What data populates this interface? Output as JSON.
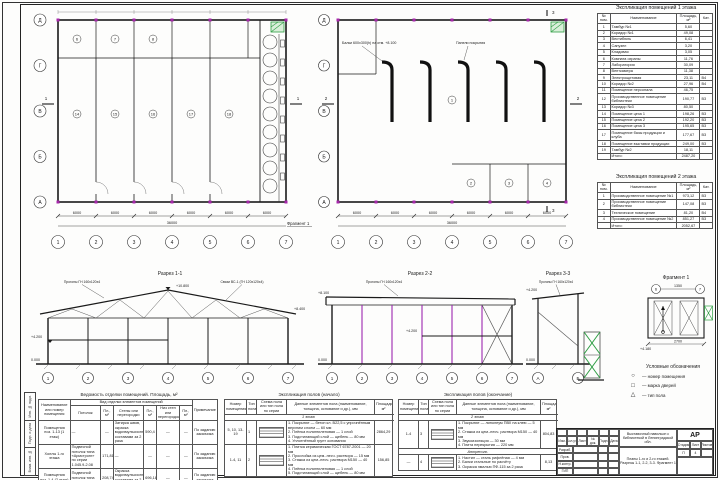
{
  "colors": {
    "line": "#1a1a1a",
    "magenta": "#a626aa",
    "green": "#2f9e44"
  },
  "plans": {
    "grid_cols": [
      "1",
      "2",
      "3",
      "4",
      "5",
      "6",
      "7"
    ],
    "grid_rows": [
      "Д",
      "Г",
      "В",
      "Б",
      "А"
    ],
    "bay_dim": "6000",
    "total_dim": "36000",
    "section_marks": {
      "s1": "1",
      "s2": "2",
      "s3": "3"
    },
    "plan1": {
      "rooms": [
        "14",
        "15",
        "16",
        "17",
        "18",
        "6",
        "7",
        "8"
      ],
      "fragment_ref": "Фрагмент 1",
      "green_note": "В-1"
    },
    "plan2": {
      "rooms": [
        "1",
        "2",
        "3",
        "4"
      ],
      "callout1": "Балки 600х300(h) на отм. +8.100",
      "callout2": "Панели покрытия"
    }
  },
  "sections": {
    "s1": {
      "title": "Разрез 1-1",
      "callout_left": "Прогоны ГН 160х120х4",
      "callout_right": "Связи ВС-1 (ГН 120х120х4)",
      "lv_ridge": "+10.800",
      "lv_eaves": "+8.400",
      "lv_floor": "+4.200",
      "lv_zero": "0.000"
    },
    "s2": {
      "title": "Разрез 2-2",
      "callout": "Прогоны ГН 160х120х4",
      "lv_top": "+8.100",
      "lv_floor": "+4.200",
      "lv_zero": "0.000"
    },
    "s3": {
      "title": "Разрез 3-3",
      "callout": "Прогоны ГН 160х120х4",
      "lv_floor": "+4.200",
      "lv_zero": "0.000"
    },
    "f1": {
      "title": "Фрагмент 1",
      "dim_top": "1350",
      "dim_bottom": "2700",
      "level": "+4.180"
    }
  },
  "legend": {
    "title": "Условные обозначения",
    "items": [
      {
        "symbol": "○",
        "label": "— номер помещения"
      },
      {
        "symbol": "□",
        "label": "— марка дверей"
      },
      {
        "symbol": "△",
        "label": "— тип пола"
      }
    ]
  },
  "tables": {
    "expl1": {
      "title": "Экспликация помещений 1 этажа",
      "headers": [
        "№ пом.",
        "Наименование",
        "Площадь, м²",
        "Кат."
      ],
      "rows": [
        [
          "1",
          "Тамбур №1",
          "5,60",
          ""
        ],
        [
          "2",
          "Коридор №1",
          "49,08",
          ""
        ],
        [
          "3",
          "Вестибюль",
          "6,41",
          ""
        ],
        [
          "4",
          "Санузел",
          "3,20",
          ""
        ],
        [
          "5",
          "Кладовая",
          "3,05",
          ""
        ],
        [
          "6",
          "Комната охраны",
          "11,76",
          ""
        ],
        [
          "7",
          "Лаборатория",
          "30,09",
          ""
        ],
        [
          "8",
          "Венткамера",
          "11,38",
          ""
        ],
        [
          "9",
          "Электрощитовая",
          "23,11",
          "В4"
        ],
        [
          "10",
          "Коридор №2",
          "27,96",
          "В4"
        ],
        [
          "11",
          "Помещение персонала",
          "46,75",
          ""
        ],
        [
          "12",
          "Производственное помещение библиотеки",
          "190,77",
          "В3"
        ],
        [
          "13",
          "Коридор №3",
          "80,50",
          ""
        ],
        [
          "14",
          "Помещение цеха 1",
          "198,26",
          "В3"
        ],
        [
          "15",
          "Помещение цеха 2",
          "192,20",
          "В3"
        ],
        [
          "16",
          "Помещение цеха 3",
          "195,65",
          "В3"
        ],
        [
          "17",
          "Помещение базы продукции и клуба",
          "177,67",
          "В3"
        ],
        [
          "18",
          "Помещение выставки продукции",
          "249,00",
          "В3"
        ],
        [
          "19",
          "Тамбур №2",
          "18,11",
          ""
        ],
        [
          "",
          "Итого:",
          "2487,20",
          ""
        ]
      ]
    },
    "expl2": {
      "title": "Экспликация помещений 2 этажа",
      "headers": [
        "№ пом.",
        "Наименование",
        "Площадь, м²",
        "Кат."
      ],
      "rows": [
        [
          "1",
          "Производственное помещение №1",
          "973,12",
          "В3"
        ],
        [
          "2",
          "Производственное помещение библиотеки",
          "147,08",
          "В3"
        ],
        [
          "3",
          "Техническое помещение",
          "81,20",
          "В4"
        ],
        [
          "4",
          "Производственное помещение №2",
          "851,27",
          "В3"
        ],
        [
          "",
          "Итого:",
          "2052,67",
          ""
        ]
      ]
    },
    "finish": {
      "title": "Ведомость отделки помещений. Площадь, м²",
      "group": "Вид отделки элементов помещений",
      "headers": [
        "Наименование или номер помещения",
        "Потолок",
        "Пл., м²",
        "Стены или перегородки",
        "Пл., м²",
        "Низ стен или перегородок",
        "Пл., м²",
        "Примечание"
      ],
      "rows": [
        [
          "Помещения поз. 1-13 (1 этаж)",
          "—",
          "—",
          "Затирка швов, окраска водоэмульсионными составами за 2 раза",
          "590,4",
          "—",
          "—",
          "По заданию заказчика"
        ],
        [
          "Холлы 1-го этажа",
          "Подвесной потолок типа «Армстронг» по серии 1.045.9-2.08",
          "171,81",
          "—",
          "—",
          "—",
          "—",
          "По заданию заказчика"
        ],
        [
          "Помещения поз. 1-4 (2 этаж)",
          "Подвесной потолок типа «Армстронг»",
          "208,74",
          "Окраска водоэмульсионными составами за 2 раза",
          "696,18",
          "—",
          "—",
          "По заданию заказчика"
        ]
      ]
    },
    "floors1": {
      "title": "Экспликация полов (начало)",
      "headers": [
        "Номер помещения",
        "Тип пола",
        "Схема пола или тип пола по серии",
        "Данные элементов пола (наименование, толщина, основание и др.), мм",
        "Площадь, м²"
      ],
      "rows": [
        [
          "@span",
          "1 этаж"
        ],
        [
          "5, 10, 13-19",
          "1",
          "@scheme",
          "1. Покрытие — бетон кл. В22,5 с упрочнённым верхним слоем — 60 мм\n2. Плёнка полиэтиленовая — 1 слой\n3. Подстилающий слой — щебень — 80 мм\n4. Уплотнённый грунт основания",
          "2864,29"
        ],
        [
          "1-4, 11",
          "2",
          "@scheme",
          "1. Плитка керамическая ГОСТ 6787-2001 — 20 мм\n2. Прослойка из цем.-песч. раствора — 15 мм\n3. Стяжка из цем.-песч. раствора М150 — 40 мм\n4. Плёнка полиэтиленовая — 1 слой\n5. Подстилающий слой — щебень — 80 мм",
          "156,85"
        ]
      ]
    },
    "floors2": {
      "title": "Экспликация полов (окончание)",
      "headers": [
        "Номер помещения",
        "Тип пола",
        "Схема пола или тип пола по серии",
        "Данные элементов пола (наименование, толщина, основание и др.), мм",
        "Площадь, м²"
      ],
      "rows": [
        [
          "@span",
          "2 этаж"
        ],
        [
          "1-4",
          "3",
          "@scheme",
          "1. Покрытие — линолеум ПВХ на клею — 5 мм\n2. Стяжка из цем.-песч. раствора М150 — 40 мм\n3. Звукоизоляция — 30 мм\n4. Плита перекрытия — 220 мм",
          "804,83"
        ],
        [
          "@span",
          "Антресоль"
        ],
        [
          "—",
          "4",
          "@scheme",
          "1. Настил — сталь рифлёная — 4 мм\n2. Балки стальные по расчёту\n3. Окраска эмалью ПФ-115 за 2 раза",
          "8,13"
        ]
      ]
    }
  },
  "titleblock": {
    "mark": "АР",
    "header_cells": [
      "Изм.",
      "Кол.уч.",
      "Лист",
      "№ док.",
      "Подп.",
      "Дата"
    ],
    "roles": [
      "Разраб.",
      "Пров.",
      "Н.контр.",
      "ГИП"
    ],
    "object_name": "Выставочный павильон с библиотекой в Ленинградской обл.",
    "sheet_name": "Планы 1-го и 2-го этажей. Разрезы 1-1, 2-2, 3-3. Фрагмент 1",
    "stage_label": "Стадия",
    "sheet_label": "Лист",
    "sheets_label": "Листов",
    "stage": "П",
    "sheet_no": "4",
    "sheets_total": ""
  },
  "frame_labels": [
    "Инв. № подл.",
    "Подп. и дата",
    "Взам. инв. №"
  ]
}
